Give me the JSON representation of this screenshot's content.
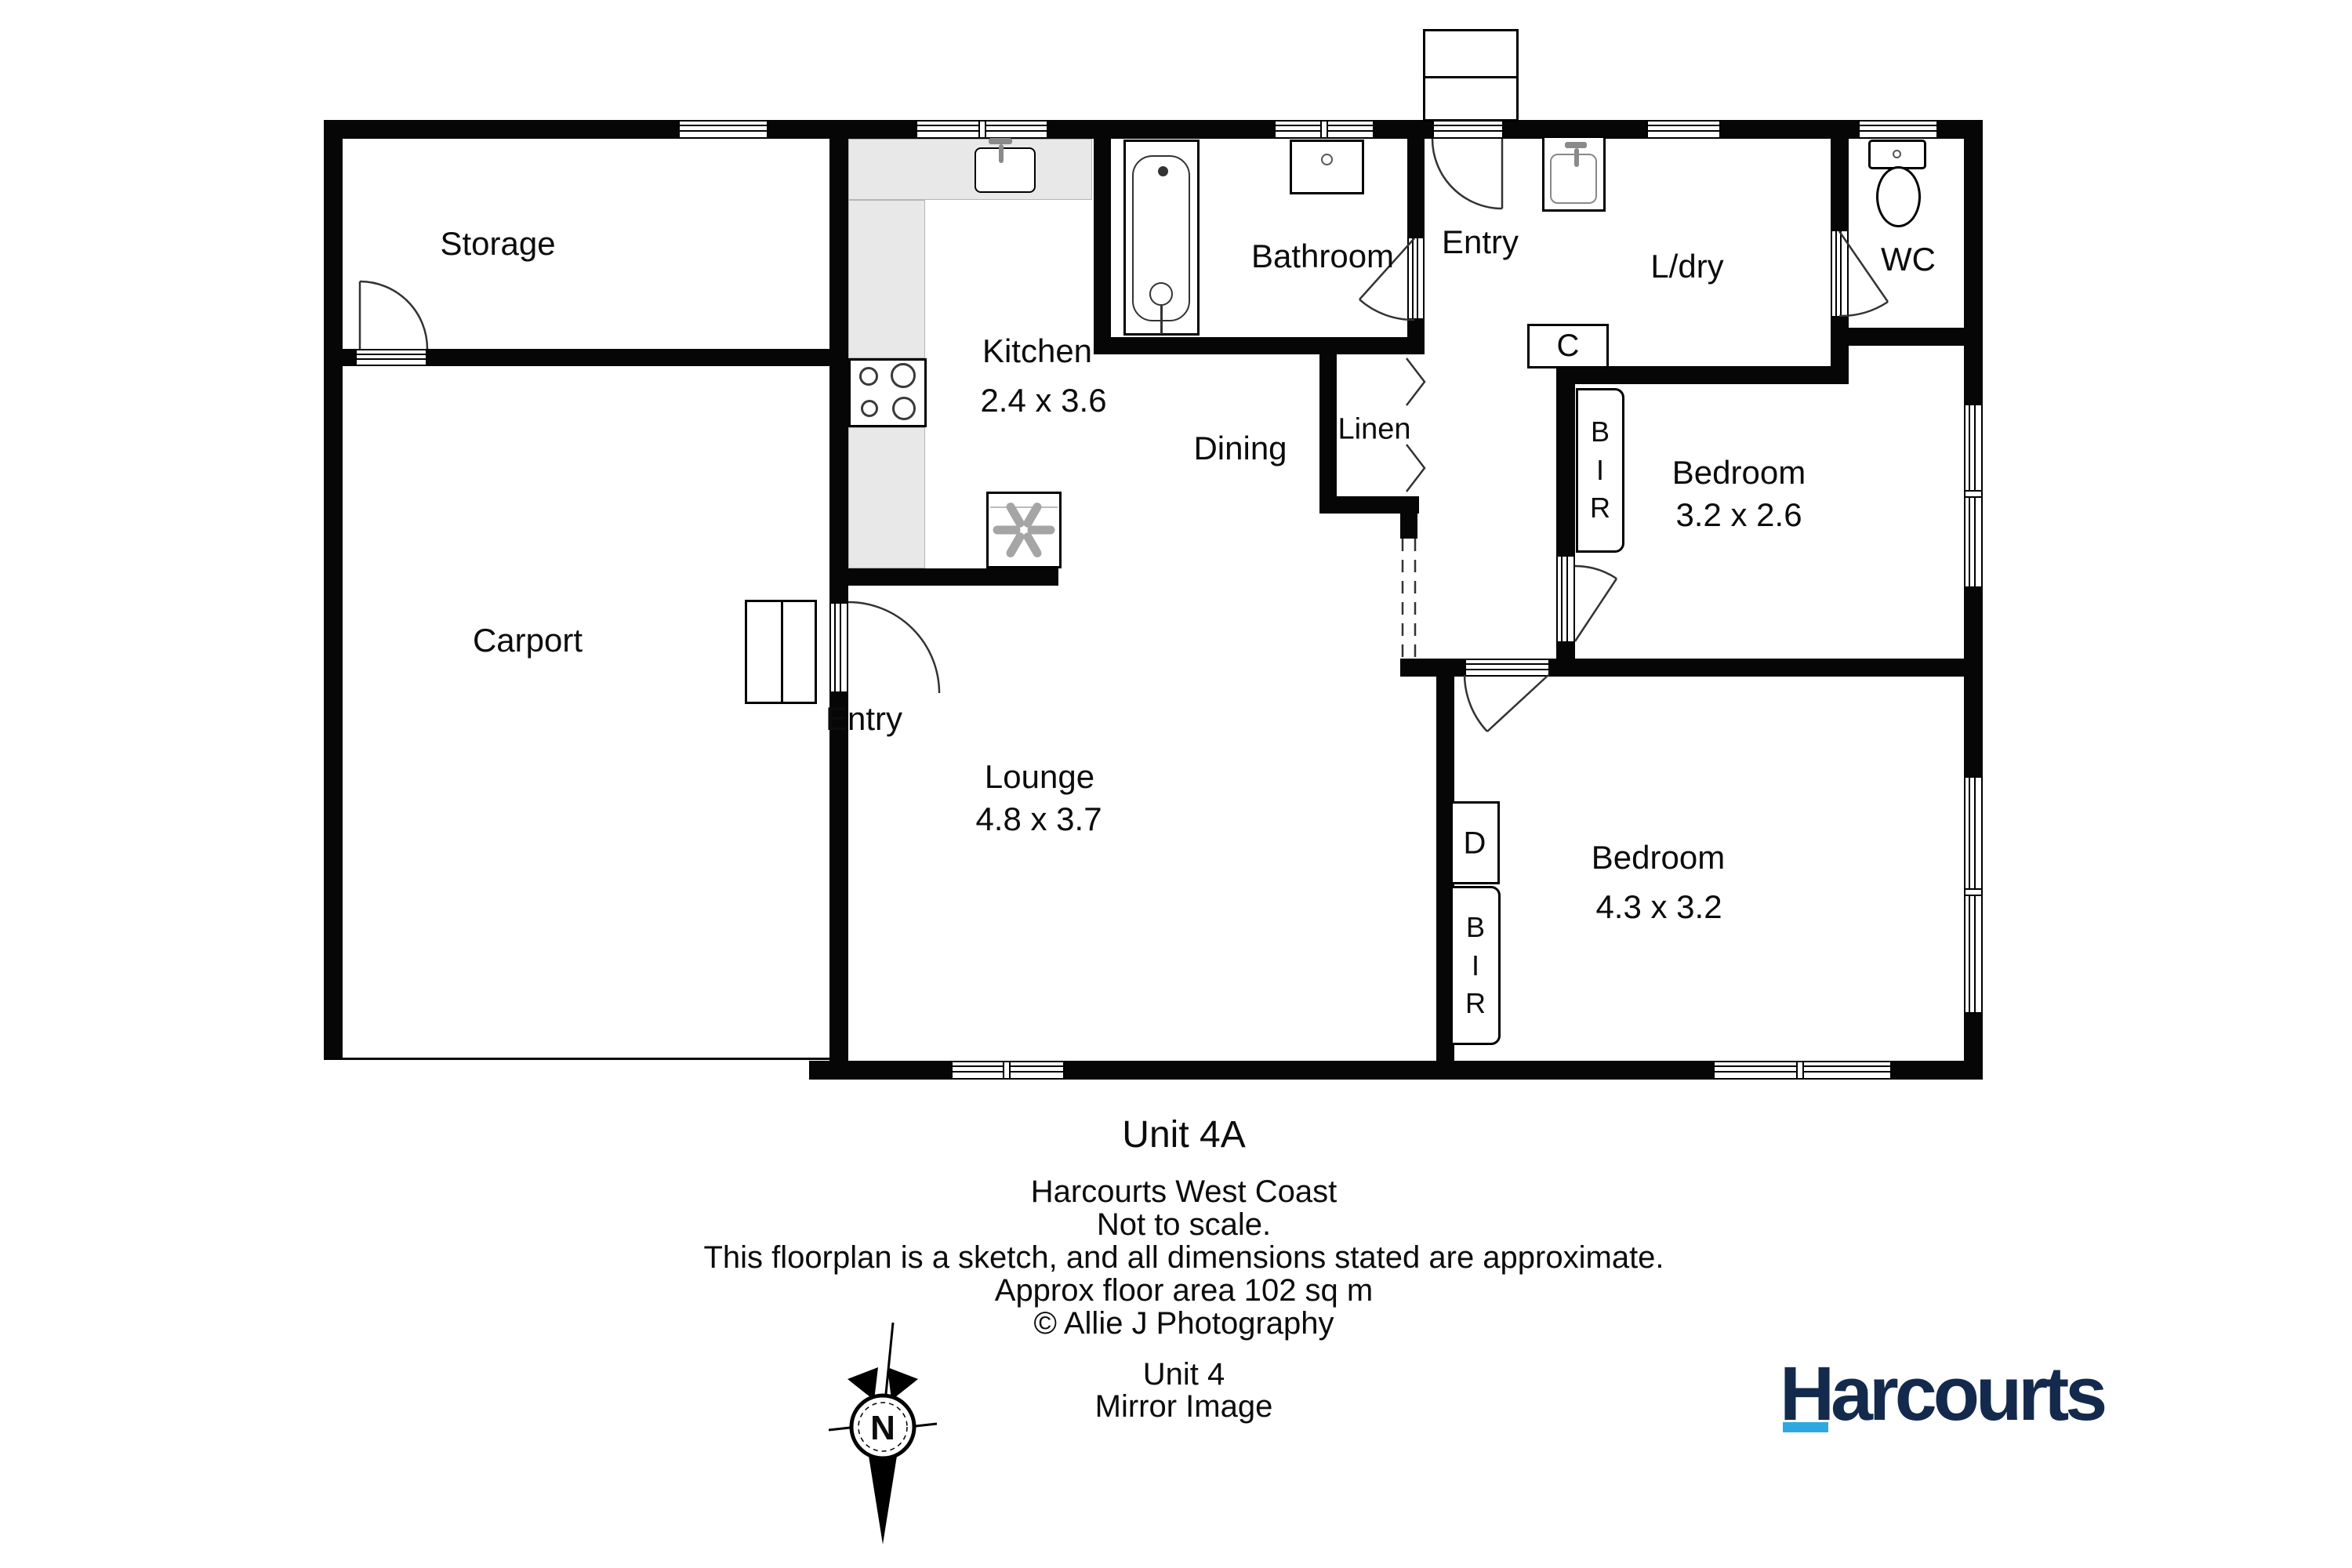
{
  "title": "Unit 4A floor plan",
  "rooms": {
    "storage": {
      "label": "Storage"
    },
    "carport": {
      "label": "Carport"
    },
    "kitchen": {
      "label": "Kitchen",
      "dims": "2.4 x 3.6"
    },
    "dining": {
      "label": "Dining"
    },
    "lounge": {
      "label": "Lounge",
      "dims": "4.8 x 3.7"
    },
    "bathroom": {
      "label": "Bathroom"
    },
    "entry_top": {
      "label": "Entry"
    },
    "entry_side": {
      "label": "Entry"
    },
    "laundry": {
      "label": "L/dry"
    },
    "wc": {
      "label": "WC"
    },
    "linen": {
      "label": "Linen"
    },
    "bedroom1": {
      "label": "Bedroom",
      "dims": "3.2 x 2.6"
    },
    "bedroom2": {
      "label": "Bedroom",
      "dims": "4.3 x 3.2"
    }
  },
  "closets": {
    "c": "C",
    "bir1": "BIR",
    "d": "D",
    "bir2": "BIR"
  },
  "compass": {
    "north_label": "N"
  },
  "footer": {
    "unit": "Unit 4A",
    "agency": "Harcourts West Coast",
    "scale_note": "Not to scale.",
    "disclaimer": "This floorplan is a sketch, and all dimensions stated are approximate.",
    "area": "Approx floor area 102 sq m",
    "credit": "© Allie J Photography",
    "unit_alt": "Unit 4",
    "mirror": "Mirror Image"
  },
  "branding": {
    "logo_text": "Harcourts",
    "accent_color": "#2EA9E0",
    "navy_color": "#142A4D"
  }
}
